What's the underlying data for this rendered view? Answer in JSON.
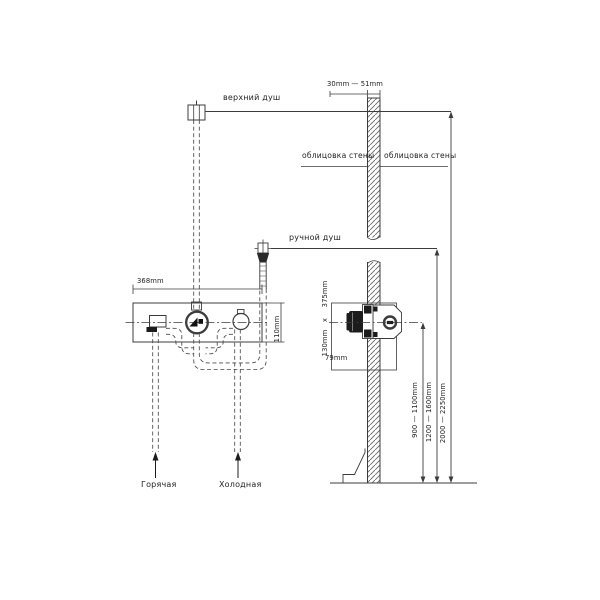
{
  "page": {
    "background": "#ffffff",
    "line_color": "#3c3c3c",
    "dark_fill": "#1c1c1c",
    "description_type": "shower-system-installation-diagram"
  },
  "labels": {
    "top_shower": "верхний душ",
    "hand_shower": "ручной душ",
    "wall_cladding_left": "облицовка стены",
    "wall_cladding_right": "облицовка стены",
    "hot_supply": "Горячая",
    "cold_supply": "Холодная"
  },
  "dimensions": {
    "wall_thickness_range": "30mm — 51mm",
    "trim_width": "368mm",
    "trim_height": "110mm",
    "roughin_height": "375mm",
    "roughin_separator": "x",
    "roughin_width": "130mm",
    "roughin_depth": "79mm",
    "mixer_height_range": "900 — 1100mm",
    "hand_shower_height_range": "1200 — 1600mm",
    "top_shower_height_range": "2000 — 2250mm"
  }
}
